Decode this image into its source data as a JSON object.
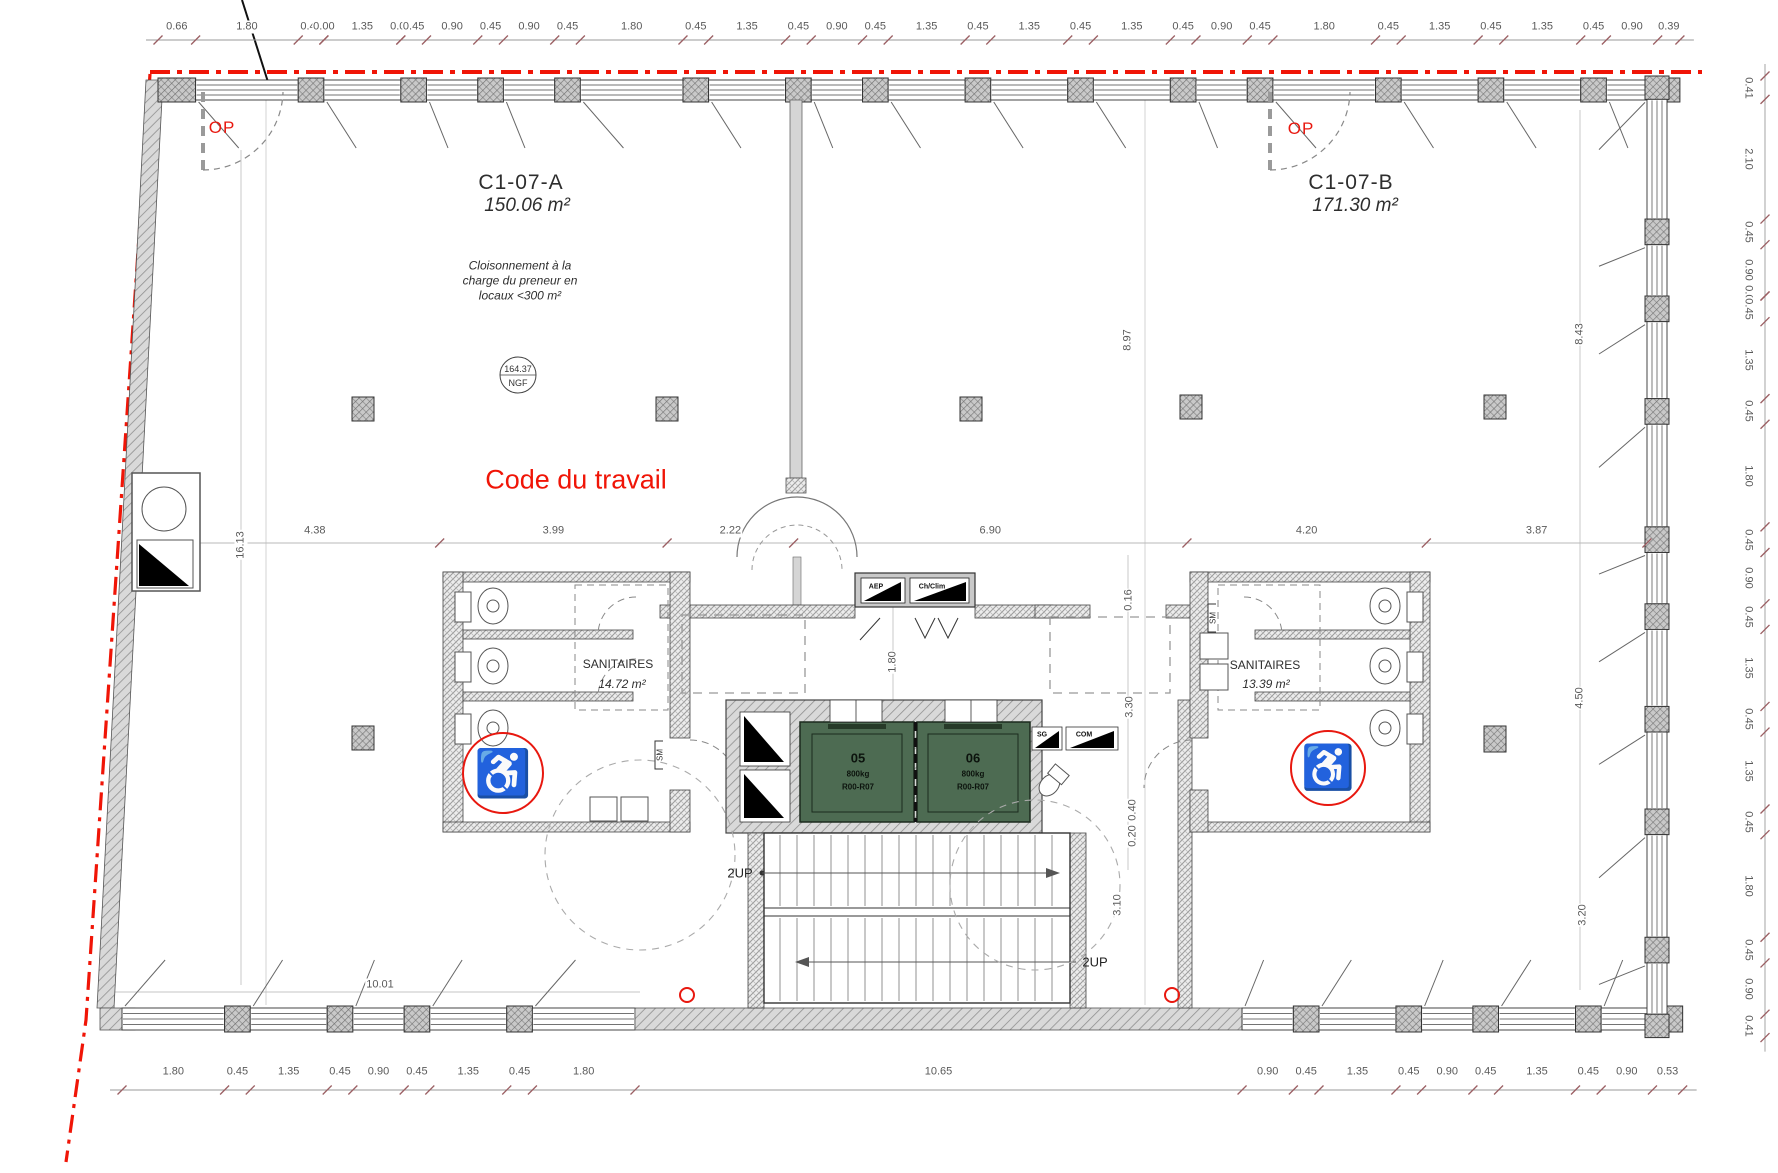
{
  "colors": {
    "property_line_red": "#f01507",
    "annotation_red": "#e8180f",
    "elevator_green": "#4d6b52",
    "wall_gray": "#d9d9d9",
    "dim_text": "#5a5a5a"
  },
  "labels": {
    "unit_a_id": "C1-07-A",
    "unit_a_area": "150.06 m²",
    "unit_b_id": "C1-07-B",
    "unit_b_area": "171.30 m²",
    "note_line1": "Cloisonnement à la",
    "note_line2": "charge du preneur en",
    "note_line3": "locaux <300 m²",
    "code_travail": "Code du travail",
    "op_left": "OP",
    "op_right": "OP",
    "ngf_value": "164.37",
    "ngf_label": "NGF",
    "sanitaires_left_name": "SANITAIRES",
    "sanitaires_left_area": "14.72 m²",
    "sanitaires_right_name": "SANITAIRES",
    "sanitaires_right_area": "13.39 m²",
    "stairs_up_left": "2UP",
    "stairs_up_right": "2UP",
    "shaft_aep": "AEP",
    "shaft_chclim": "Ch/Clim",
    "shaft_sg": "SG",
    "shaft_com": "COM",
    "sm_left": "SM",
    "sm_right": "SM",
    "dim_10_01": "10.01",
    "wheelchair_symbol": "♿"
  },
  "elevators": [
    {
      "id": "05",
      "capacity": "800kg",
      "levels": "R00-R07"
    },
    {
      "id": "06",
      "capacity": "800kg",
      "levels": "R00-R07"
    }
  ],
  "dim_chains": {
    "top": [
      "0.66",
      "1.80",
      "0.45",
      "0.00",
      "1.35",
      "0.00",
      "0.45",
      "0.90",
      "0.45",
      "0.90",
      "0.45",
      "1.80",
      "0.45",
      "1.35",
      "0.45",
      "0.90",
      "0.45",
      "1.35",
      "0.45",
      "1.35",
      "0.45",
      "1.35",
      "0.45",
      "0.90",
      "0.45",
      "1.80",
      "0.45",
      "1.35",
      "0.45",
      "1.35",
      "0.45",
      "0.90",
      "0.39"
    ],
    "bottom": [
      "1.80",
      "0.45",
      "1.35",
      "0.45",
      "0.90",
      "0.45",
      "1.35",
      "0.45",
      "1.80",
      "10.65",
      "0.90",
      "0.45",
      "1.35",
      "0.45",
      "0.90",
      "0.45",
      "1.35",
      "0.45",
      "0.90",
      "0.53"
    ],
    "right": [
      "0.41",
      "2.10",
      "0.45",
      "0.90",
      "0.00",
      "0.45",
      "1.35",
      "0.45",
      "1.80",
      "0.45",
      "0.90",
      "0.45",
      "1.35",
      "0.45",
      "1.35",
      "0.45",
      "1.80",
      "0.45",
      "0.90",
      "0.41"
    ]
  },
  "interior_dims_h": [
    "4.38",
    "3.99",
    "2.22",
    "6.90",
    "4.20",
    "3.87"
  ],
  "interior_dims_v": [
    "16.13",
    "8.97",
    "8.43",
    "4.50",
    "3.20",
    "3.30",
    "3.10",
    "1.80",
    "0.16",
    "0.40",
    "0.20"
  ]
}
